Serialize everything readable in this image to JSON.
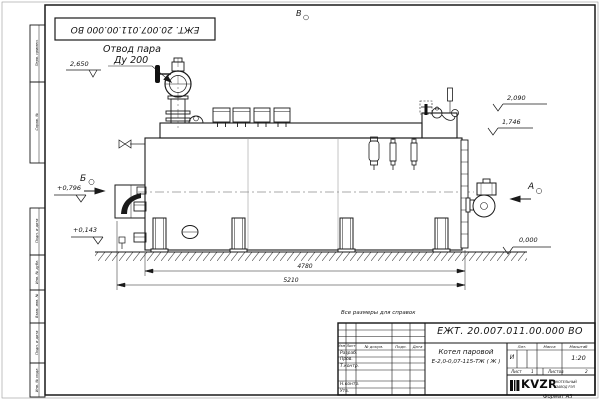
{
  "drawing": {
    "code_stamp": "ЕЖТ. 20.007.011.00.000  ВО",
    "reference_note": "Все размеры для справок",
    "format_label": "Формат А3"
  },
  "frame_cells": [
    "Перв. примен.",
    "Справ. №",
    "Подп. и дата",
    "Инв. № дубл.",
    "Взам. инв. №",
    "Подп. и дата",
    "Инв. № подл."
  ],
  "callouts": {
    "steam_outlet_line1": "Отвод пара",
    "steam_outlet_line2": "Ду 200",
    "view_top": "В",
    "view_left": "Б",
    "view_right": "А"
  },
  "elevations": {
    "valve_top": "2,650",
    "deck_right": "2,090",
    "shell_top_right": "1,746",
    "burner_axis": "+0,796",
    "manhole": "+0,143",
    "ground": "0,000"
  },
  "dimensions": {
    "shell_length": "4780",
    "overall_length": "5210"
  },
  "title_block": {
    "doc_number": "ЕЖТ. 20.007.011.00.000  ВО",
    "product_line1": "Котел паровой",
    "product_line2": "Е-2,0-0,07-115-ТЖ ( Ж )",
    "columns": {
      "izm": "Изм",
      "list": "Лист",
      "docum": "№ докум.",
      "podp": "Подп.",
      "data": "Дата"
    },
    "rows": {
      "razrab": "Разраб.",
      "prov": "Пров.",
      "tkontr": "Т.контр.",
      "nkontr": "Н.контр.",
      "utv": "Утв."
    },
    "lit_label": "Лит.",
    "mass_label": "Масса",
    "scale_label": "Масштаб",
    "lit_value": "И",
    "scale_value": "1:20",
    "sheet_label": "Лист",
    "sheet_number": "1",
    "sheets_label": "Листов",
    "sheets_total": "2",
    "logo_text": "KVZR",
    "logo_sub1": "КОТЕЛЬНЫЙ",
    "logo_sub2": "ЗАВОД РЭП"
  }
}
